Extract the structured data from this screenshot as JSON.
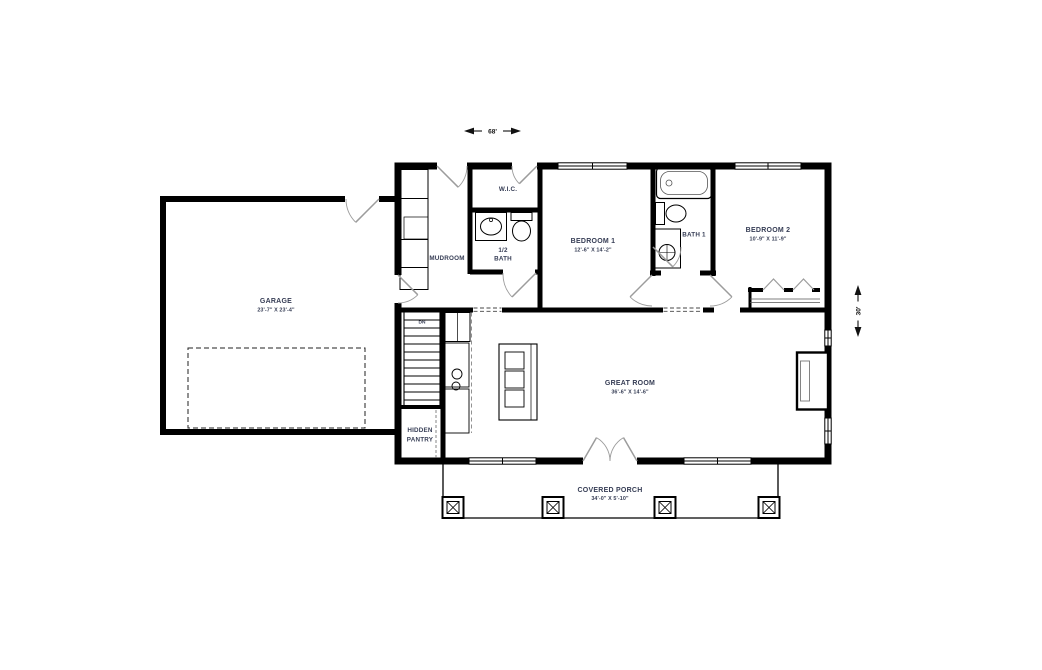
{
  "plan": {
    "dimensions": {
      "width": "68'",
      "depth": "30'"
    },
    "rooms": {
      "garage": {
        "name": "GARAGE",
        "size": "23'-7\" X 23'-4\""
      },
      "mudroom": {
        "name": "MUDROOM"
      },
      "wic": {
        "name": "W.I.C."
      },
      "half_bath": {
        "line1": "1/2",
        "line2": "BATH"
      },
      "bedroom1": {
        "name": "BEDROOM 1",
        "size": "12'-6\" X 14'-2\""
      },
      "bath1": {
        "name": "BATH 1"
      },
      "bedroom2": {
        "name": "BEDROOM 2",
        "size": "10'-9\" X 11'-9\""
      },
      "great_room": {
        "name": "GREAT ROOM",
        "size": "36'-6\" X 14'-6\""
      },
      "hidden_pantry": {
        "line1": "HIDDEN",
        "line2": "PANTRY"
      },
      "covered_porch": {
        "name": "COVERED PORCH",
        "size": "34'-0\" X 5'-10\""
      },
      "stairs": {
        "label": "DN"
      }
    },
    "colors": {
      "wall": "#000000",
      "label_text": "#363d55",
      "door_swing": "#9c9c9c",
      "dimension": "#111111"
    }
  }
}
